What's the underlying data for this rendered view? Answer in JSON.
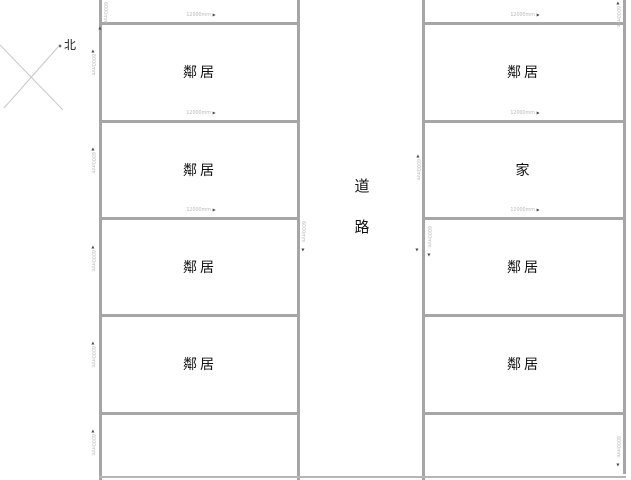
{
  "compass": {
    "north_label": "北"
  },
  "road": {
    "label": "道\n路"
  },
  "left_column": {
    "lots": [
      {
        "label": "鄰居"
      },
      {
        "label": "鄰居"
      },
      {
        "label": "鄰居"
      },
      {
        "label": "鄰居"
      }
    ]
  },
  "right_column": {
    "lots": [
      {
        "label": "鄰居"
      },
      {
        "label": "家"
      },
      {
        "label": "鄰居"
      },
      {
        "label": "鄰居"
      }
    ]
  },
  "dimensions": {
    "width_value": "12000mm",
    "height_value": "6000mm",
    "arrow_right": "▶",
    "arrow_up": "▲",
    "arrow_down": "▼"
  },
  "colors": {
    "boundary_line": "#a6a6a6",
    "dimension_text": "#b9b9b9",
    "dimension_arrow": "#4a4a4a",
    "label_text": "#111111",
    "compass_line": "#c9c9c9"
  }
}
